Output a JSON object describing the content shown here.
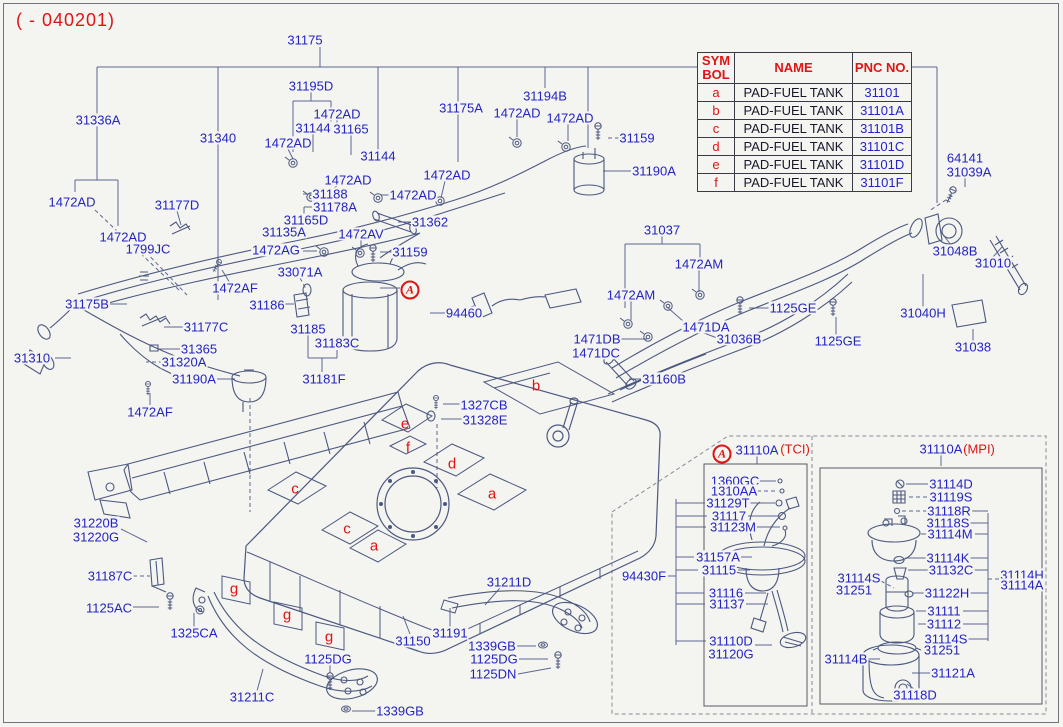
{
  "header": {
    "revision_code": "( - 040201)"
  },
  "table": {
    "headers": {
      "symbol": "SYM BOL",
      "name": "NAME",
      "pnc": "PNC NO."
    },
    "rows": [
      {
        "sym": "a",
        "name": "PAD-FUEL TANK",
        "pnc": "31101"
      },
      {
        "sym": "b",
        "name": "PAD-FUEL TANK",
        "pnc": "31101A"
      },
      {
        "sym": "c",
        "name": "PAD-FUEL TANK",
        "pnc": "31101B"
      },
      {
        "sym": "d",
        "name": "PAD-FUEL TANK",
        "pnc": "31101C"
      },
      {
        "sym": "e",
        "name": "PAD-FUEL TANK",
        "pnc": "31101D"
      },
      {
        "sym": "f",
        "name": "PAD-FUEL TANK",
        "pnc": "31101F"
      }
    ]
  },
  "markers": {
    "assembly_ref": "A"
  },
  "callouts": {
    "tci": {
      "ref": "A",
      "part_no": "31110A",
      "variant": "(TCI)"
    },
    "mpi": {
      "part_no": "31110A",
      "variant": "(MPI)"
    }
  },
  "colors": {
    "label_blue": "#2424c4",
    "accent_red": "#e01414",
    "line_art": "#4c5880",
    "background": "#f4f4f0"
  },
  "part_labels": [
    {
      "text": "31175",
      "x": 305,
      "y": 40
    },
    {
      "text": "31195D",
      "x": 311,
      "y": 86
    },
    {
      "text": "1472AD",
      "x": 337,
      "y": 114
    },
    {
      "text": "31144",
      "x": 313,
      "y": 128
    },
    {
      "text": "31165",
      "x": 351,
      "y": 129
    },
    {
      "text": "1472AD",
      "x": 288,
      "y": 143
    },
    {
      "text": "31340",
      "x": 218,
      "y": 138
    },
    {
      "text": "31336A",
      "x": 98,
      "y": 120
    },
    {
      "text": "31175A",
      "x": 461,
      "y": 108
    },
    {
      "text": "31194B",
      "x": 545,
      "y": 96
    },
    {
      "text": "1472AD",
      "x": 517,
      "y": 113
    },
    {
      "text": "1472AD",
      "x": 570,
      "y": 118
    },
    {
      "text": "31159",
      "x": 637,
      "y": 138
    },
    {
      "text": "31190A",
      "x": 654,
      "y": 171
    },
    {
      "text": "31144",
      "x": 378,
      "y": 156
    },
    {
      "text": "1472AD",
      "x": 348,
      "y": 180
    },
    {
      "text": "1472AD",
      "x": 447,
      "y": 175
    },
    {
      "text": "1472AD",
      "x": 413,
      "y": 195
    },
    {
      "text": "31188",
      "x": 330,
      "y": 194
    },
    {
      "text": "31178A",
      "x": 335,
      "y": 207
    },
    {
      "text": "1472AD",
      "x": 72,
      "y": 202
    },
    {
      "text": "31177D",
      "x": 177,
      "y": 205
    },
    {
      "text": "31165D",
      "x": 306,
      "y": 220
    },
    {
      "text": "31362",
      "x": 430,
      "y": 222
    },
    {
      "text": "1472AD",
      "x": 123,
      "y": 237
    },
    {
      "text": "31135A",
      "x": 284,
      "y": 232
    },
    {
      "text": "1799JC",
      "x": 148,
      "y": 249
    },
    {
      "text": "1472AV",
      "x": 361,
      "y": 234
    },
    {
      "text": "1472AG",
      "x": 276,
      "y": 250
    },
    {
      "text": "33071A",
      "x": 300,
      "y": 272
    },
    {
      "text": "31159",
      "x": 410,
      "y": 252
    },
    {
      "text": "1472AF",
      "x": 235,
      "y": 288
    },
    {
      "text": "31175B",
      "x": 87,
      "y": 304
    },
    {
      "text": "31186",
      "x": 267,
      "y": 305
    },
    {
      "text": "94460",
      "x": 464,
      "y": 313
    },
    {
      "text": "31177C",
      "x": 206,
      "y": 327
    },
    {
      "text": "31185",
      "x": 308,
      "y": 329
    },
    {
      "text": "31365",
      "x": 199,
      "y": 349
    },
    {
      "text": "31183C",
      "x": 337,
      "y": 343
    },
    {
      "text": "31310",
      "x": 32,
      "y": 358
    },
    {
      "text": "31320A",
      "x": 184,
      "y": 362
    },
    {
      "text": "31190A",
      "x": 194,
      "y": 379
    },
    {
      "text": "31181F",
      "x": 324,
      "y": 379
    },
    {
      "text": "1472AF",
      "x": 150,
      "y": 412
    },
    {
      "text": "1327CB",
      "x": 484,
      "y": 405
    },
    {
      "text": "31328E",
      "x": 485,
      "y": 420
    },
    {
      "text": "31037",
      "x": 662,
      "y": 230
    },
    {
      "text": "1472AM",
      "x": 699,
      "y": 264
    },
    {
      "text": "1472AM",
      "x": 631,
      "y": 295
    },
    {
      "text": "1125GE",
      "x": 793,
      "y": 308
    },
    {
      "text": "1471DA",
      "x": 706,
      "y": 327
    },
    {
      "text": "31036B",
      "x": 739,
      "y": 339
    },
    {
      "text": "1471DB",
      "x": 597,
      "y": 339
    },
    {
      "text": "1471DC",
      "x": 596,
      "y": 353
    },
    {
      "text": "1125GE",
      "x": 838,
      "y": 341
    },
    {
      "text": "31160B",
      "x": 664,
      "y": 379
    },
    {
      "text": "64141",
      "x": 965,
      "y": 158
    },
    {
      "text": "31039A",
      "x": 969,
      "y": 172
    },
    {
      "text": "31048B",
      "x": 955,
      "y": 251
    },
    {
      "text": "31010",
      "x": 993,
      "y": 263
    },
    {
      "text": "31040H",
      "x": 923,
      "y": 313
    },
    {
      "text": "31038",
      "x": 973,
      "y": 347
    },
    {
      "text": "31220B",
      "x": 96,
      "y": 523
    },
    {
      "text": "31220G",
      "x": 96,
      "y": 537
    },
    {
      "text": "31187C",
      "x": 110,
      "y": 576
    },
    {
      "text": "1125AC",
      "x": 109,
      "y": 608
    },
    {
      "text": "1325CA",
      "x": 194,
      "y": 633
    },
    {
      "text": "1125DG",
      "x": 328,
      "y": 659
    },
    {
      "text": "31211C",
      "x": 252,
      "y": 697
    },
    {
      "text": "31211D",
      "x": 509,
      "y": 582
    },
    {
      "text": "31150",
      "x": 413,
      "y": 641
    },
    {
      "text": "31191",
      "x": 450,
      "y": 633
    },
    {
      "text": "1339GB",
      "x": 492,
      "y": 646
    },
    {
      "text": "1125DG",
      "x": 494,
      "y": 659
    },
    {
      "text": "1125DN",
      "x": 493,
      "y": 674
    },
    {
      "text": "1339GB",
      "x": 400,
      "y": 711
    },
    {
      "text": "1360GC",
      "x": 735,
      "y": 481
    },
    {
      "text": "1310AA",
      "x": 734,
      "y": 491
    },
    {
      "text": "31129T",
      "x": 728,
      "y": 503
    },
    {
      "text": "31117",
      "x": 729,
      "y": 516
    },
    {
      "text": "31123M",
      "x": 733,
      "y": 527
    },
    {
      "text": "31157A",
      "x": 718,
      "y": 557
    },
    {
      "text": "31115",
      "x": 719,
      "y": 570
    },
    {
      "text": "94430F",
      "x": 644,
      "y": 576
    },
    {
      "text": "31116",
      "x": 726,
      "y": 593
    },
    {
      "text": "31137",
      "x": 727,
      "y": 604
    },
    {
      "text": "31110D",
      "x": 731,
      "y": 641
    },
    {
      "text": "31120G",
      "x": 731,
      "y": 654
    },
    {
      "text": "31114D",
      "x": 951,
      "y": 484
    },
    {
      "text": "31119S",
      "x": 951,
      "y": 497
    },
    {
      "text": "31118R",
      "x": 949,
      "y": 511
    },
    {
      "text": "31118S",
      "x": 948,
      "y": 523
    },
    {
      "text": "31114M",
      "x": 950,
      "y": 534
    },
    {
      "text": "31114K",
      "x": 948,
      "y": 558
    },
    {
      "text": "31132C",
      "x": 951,
      "y": 570
    },
    {
      "text": "31114S",
      "x": 859,
      "y": 578
    },
    {
      "text": "31251",
      "x": 854,
      "y": 590
    },
    {
      "text": "31122H",
      "x": 947,
      "y": 593
    },
    {
      "text": "31114H",
      "x": 1022,
      "y": 575
    },
    {
      "text": "31114A",
      "x": 1022,
      "y": 585
    },
    {
      "text": "31111",
      "x": 944,
      "y": 611
    },
    {
      "text": "31112",
      "x": 944,
      "y": 624
    },
    {
      "text": "31114S",
      "x": 946,
      "y": 639
    },
    {
      "text": "31251",
      "x": 942,
      "y": 650
    },
    {
      "text": "31114B",
      "x": 846,
      "y": 659
    },
    {
      "text": "31121A",
      "x": 953,
      "y": 673
    },
    {
      "text": "31118D",
      "x": 915,
      "y": 695
    }
  ],
  "tank_symbols": [
    {
      "text": "b",
      "x": 536,
      "y": 386
    },
    {
      "text": "e",
      "x": 405,
      "y": 424
    },
    {
      "text": "f",
      "x": 408,
      "y": 448
    },
    {
      "text": "d",
      "x": 452,
      "y": 464
    },
    {
      "text": "a",
      "x": 492,
      "y": 494
    },
    {
      "text": "c",
      "x": 295,
      "y": 489
    },
    {
      "text": "c",
      "x": 347,
      "y": 529
    },
    {
      "text": "a",
      "x": 374,
      "y": 546
    },
    {
      "text": "g",
      "x": 234,
      "y": 589
    },
    {
      "text": "g",
      "x": 287,
      "y": 615
    },
    {
      "text": "g",
      "x": 329,
      "y": 637
    }
  ]
}
